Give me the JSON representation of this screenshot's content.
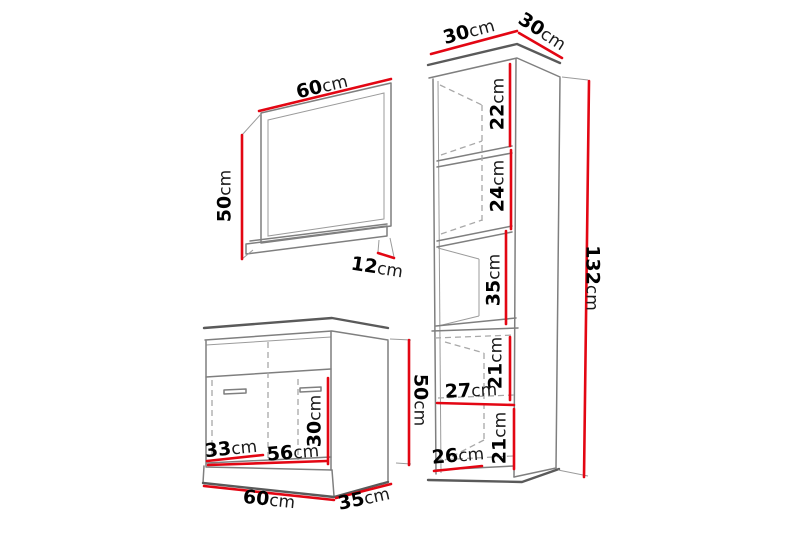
{
  "title": "Bathroom furniture set dimension diagram",
  "colors": {
    "dimension_red": "#e30613",
    "outline_gray": "#7f7f7f",
    "background": "#ffffff",
    "text": "#000000"
  },
  "furniture_items": [
    {
      "id": "mirror",
      "label": "wall mirror with shelf"
    },
    {
      "id": "vanity",
      "label": "washbasin cabinet with two doors"
    },
    {
      "id": "tall-cabinet",
      "label": "tall bathroom column cabinet"
    }
  ],
  "dims": {
    "mirror_width": {
      "num": "60",
      "unit": "cm"
    },
    "mirror_height": {
      "num": "50",
      "unit": "cm"
    },
    "mirror_shelf_depth": {
      "num": "12",
      "unit": "cm"
    },
    "vanity_inner_height": {
      "num": "30",
      "unit": "cm"
    },
    "vanity_door_width": {
      "num": "33",
      "unit": "cm"
    },
    "vanity_inner_width": {
      "num": "56",
      "unit": "cm"
    },
    "vanity_height": {
      "num": "50",
      "unit": "cm"
    },
    "vanity_width": {
      "num": "60",
      "unit": "cm"
    },
    "vanity_depth": {
      "num": "35",
      "unit": "cm"
    },
    "tall_width": {
      "num": "30",
      "unit": "cm"
    },
    "tall_depth": {
      "num": "30",
      "unit": "cm"
    },
    "tall_shelf_1": {
      "num": "22",
      "unit": "cm"
    },
    "tall_shelf_2": {
      "num": "24",
      "unit": "cm"
    },
    "tall_niche_height": {
      "num": "35",
      "unit": "cm"
    },
    "tall_compartment_1": {
      "num": "21",
      "unit": "cm"
    },
    "tall_inner_width": {
      "num": "27",
      "unit": "cm"
    },
    "tall_compartment_2": {
      "num": "21",
      "unit": "cm"
    },
    "tall_base_width": {
      "num": "26",
      "unit": "cm"
    },
    "tall_height": {
      "num": "132",
      "unit": "cm"
    }
  }
}
